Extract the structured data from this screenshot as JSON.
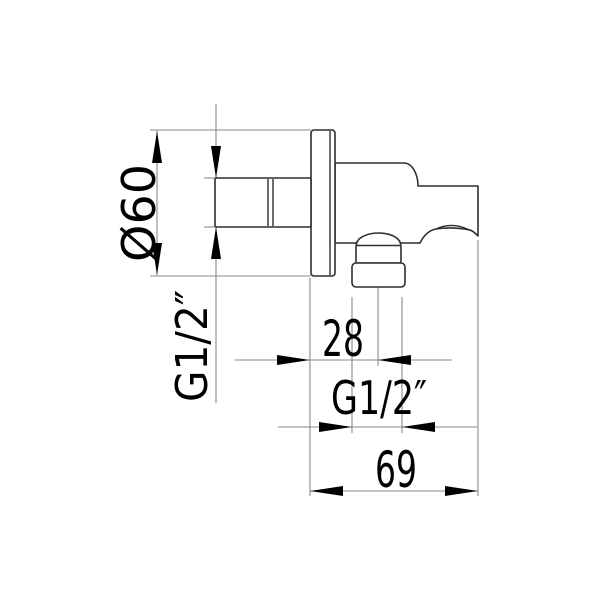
{
  "drawing": {
    "kind": "technical-dimension-drawing",
    "colors": {
      "background": "#ffffff",
      "part_outline": "#2f2f2f",
      "dimension_lines": "#8a8a8a",
      "text_and_arrows": "#000000"
    },
    "dimensions": {
      "flange_diameter": {
        "label": "Ø60",
        "value": 60,
        "orientation": "vertical-rotated"
      },
      "inlet_thread": {
        "label": "G1/2″",
        "orientation": "vertical-rotated"
      },
      "outlet_offset": {
        "label": "28",
        "value": 28,
        "orientation": "horizontal"
      },
      "outlet_thread": {
        "label": "G1/2″",
        "orientation": "horizontal"
      },
      "overall_depth": {
        "label": "69",
        "value": 69,
        "orientation": "horizontal"
      }
    }
  }
}
